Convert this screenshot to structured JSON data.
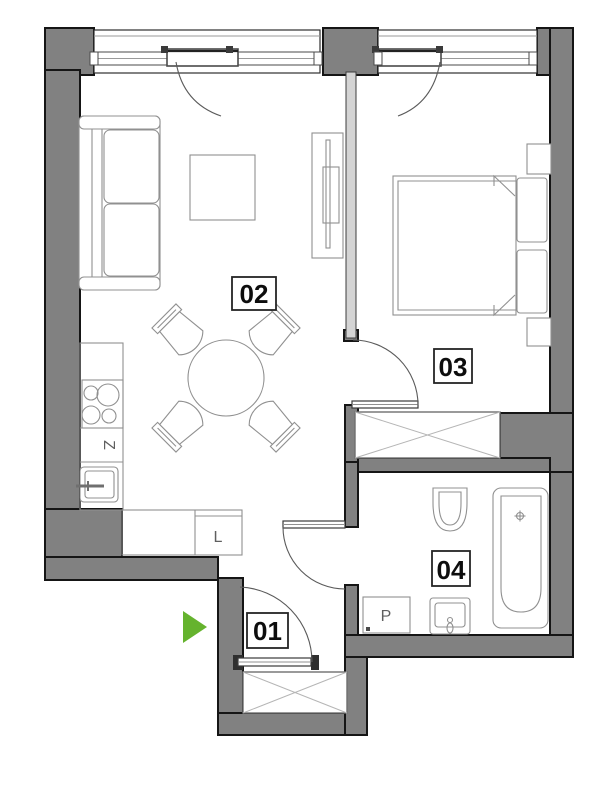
{
  "floorplan": {
    "room_labels": {
      "entry": "01",
      "living": "02",
      "bedroom": "03",
      "bathroom": "04"
    },
    "appliance_labels": {
      "kitchen_z": "Z",
      "kitchen_l": "L",
      "bathroom_p": "P"
    },
    "colors": {
      "exterior_wall": "#818181",
      "partition": "#d4d4d4",
      "entry_arrow": "#65b32e"
    }
  }
}
